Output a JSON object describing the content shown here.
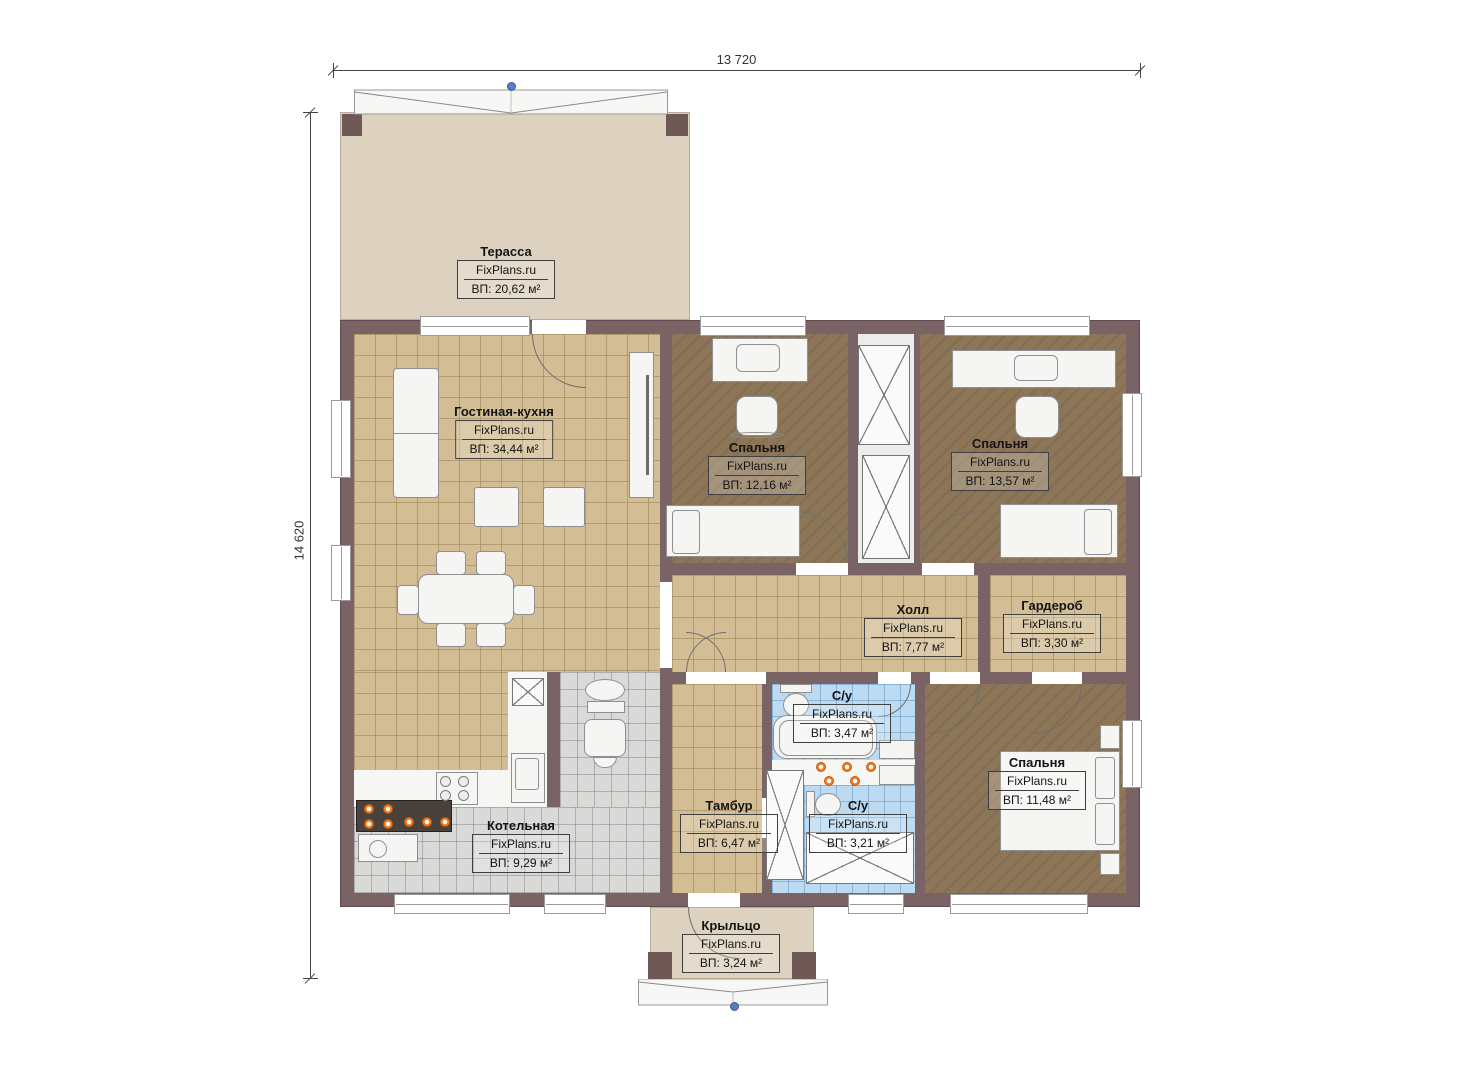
{
  "watermark": "FixPlans.ru",
  "dimensions": {
    "width_label": "13 720",
    "height_label": "14 620"
  },
  "rooms": {
    "terrace": {
      "name": "Терасса",
      "area": "ВП: 20,62 м²"
    },
    "living": {
      "name": "Гостиная-кухня",
      "area": "ВП: 34,44 м²"
    },
    "bedroom1": {
      "name": "Спальня",
      "area": "ВП: 12,16 м²"
    },
    "bedroom2": {
      "name": "Спальня",
      "area": "ВП: 13,57 м²"
    },
    "hall": {
      "name": "Холл",
      "area": "ВП: 7,77 м²"
    },
    "garderob": {
      "name": "Гардероб",
      "area": "ВП: 3,30 м²"
    },
    "bath1": {
      "name": "С/у",
      "area": "ВП: 3,47 м²"
    },
    "bath2": {
      "name": "С/у",
      "area": "ВП: 3,21 м²"
    },
    "bedroom3": {
      "name": "Спальня",
      "area": "ВП: 11,48 м²"
    },
    "tambur": {
      "name": "Тамбур",
      "area": "ВП: 6,47 м²"
    },
    "boiler": {
      "name": "Котельная",
      "area": "ВП: 9,29 м²"
    },
    "porch": {
      "name": "Крыльцо",
      "area": "ВП: 3,24 м²"
    }
  },
  "colors": {
    "wall": "#7a6365",
    "terrace_floor": "#ddd1bf",
    "tan_tile": "#d3bd94",
    "dark_floor": "#8d7557",
    "blue_tile": "#bcdaf1",
    "gray_tile": "#d9d9d8",
    "burner_orange": "#ef7a1e",
    "roof_node_blue": "#5a7bbd"
  }
}
